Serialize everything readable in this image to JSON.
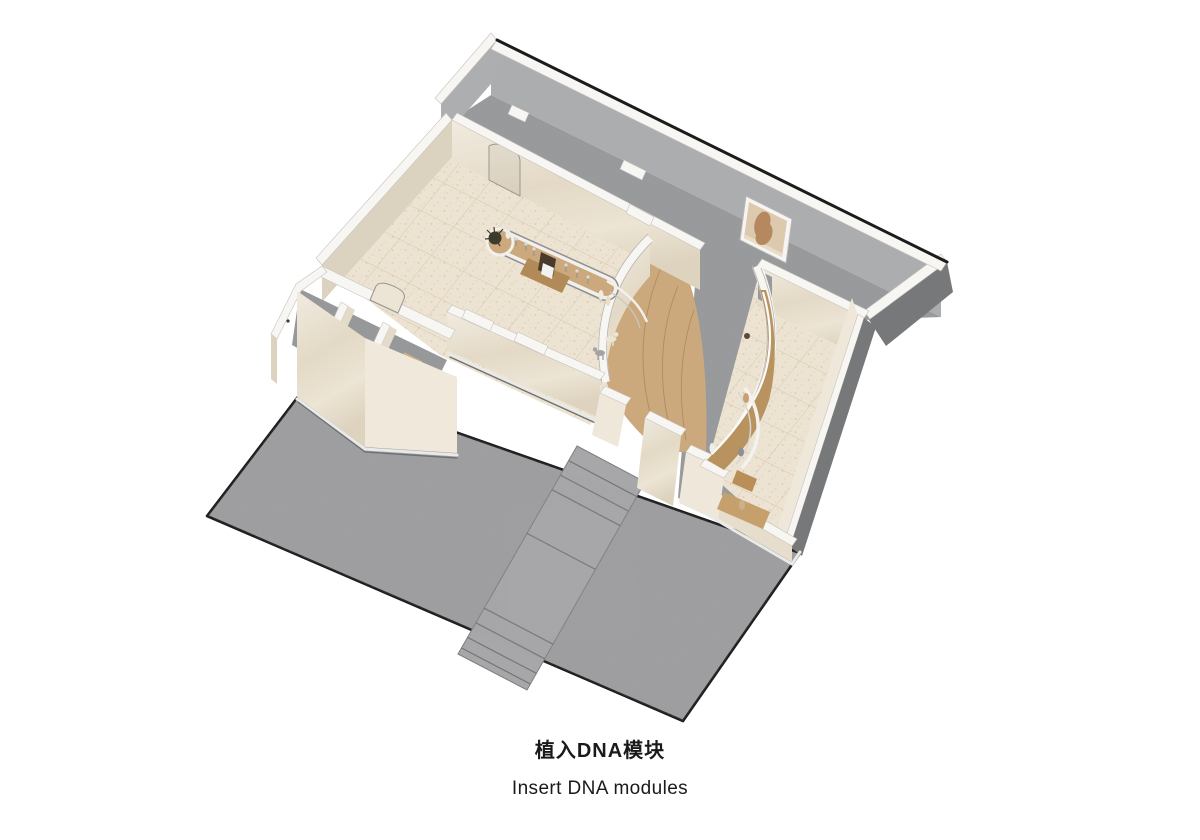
{
  "caption": {
    "title_zh": "植入DNA模块",
    "subtitle_en": "Insert DNA modules"
  },
  "palette": {
    "background": "#ffffff",
    "outline": "#1c1c1c",
    "plaza_concrete": "#9e9ea0",
    "stair_concrete": "#a7a7a9",
    "corridor_floor": "#98999b",
    "back_wall_face": "#adaeb0",
    "wall_cream": "#e9e1d1",
    "wall_cream_dark": "#dcd2c0",
    "wall_cap_white": "#f7f6f3",
    "room_floor": "#ece3d2",
    "floor_speckle": "#d9bf9b",
    "wood_light": "#cba97d",
    "wood_mid": "#b9935f",
    "wood_dark": "#b28a58",
    "rail_white": "#f2f0ec",
    "gray_interior": "#97989a",
    "plinth_dark": "#77787a",
    "plant_dark": "#3d3a2e",
    "screen_dark": "#4a3a2c",
    "figure_cream": "#ece5d2",
    "figure_gray": "#a3a3a3",
    "artwork_bg": "#dcc9ae",
    "artwork_figure": "#b5885f",
    "caption_text": "#1a1a1a"
  }
}
